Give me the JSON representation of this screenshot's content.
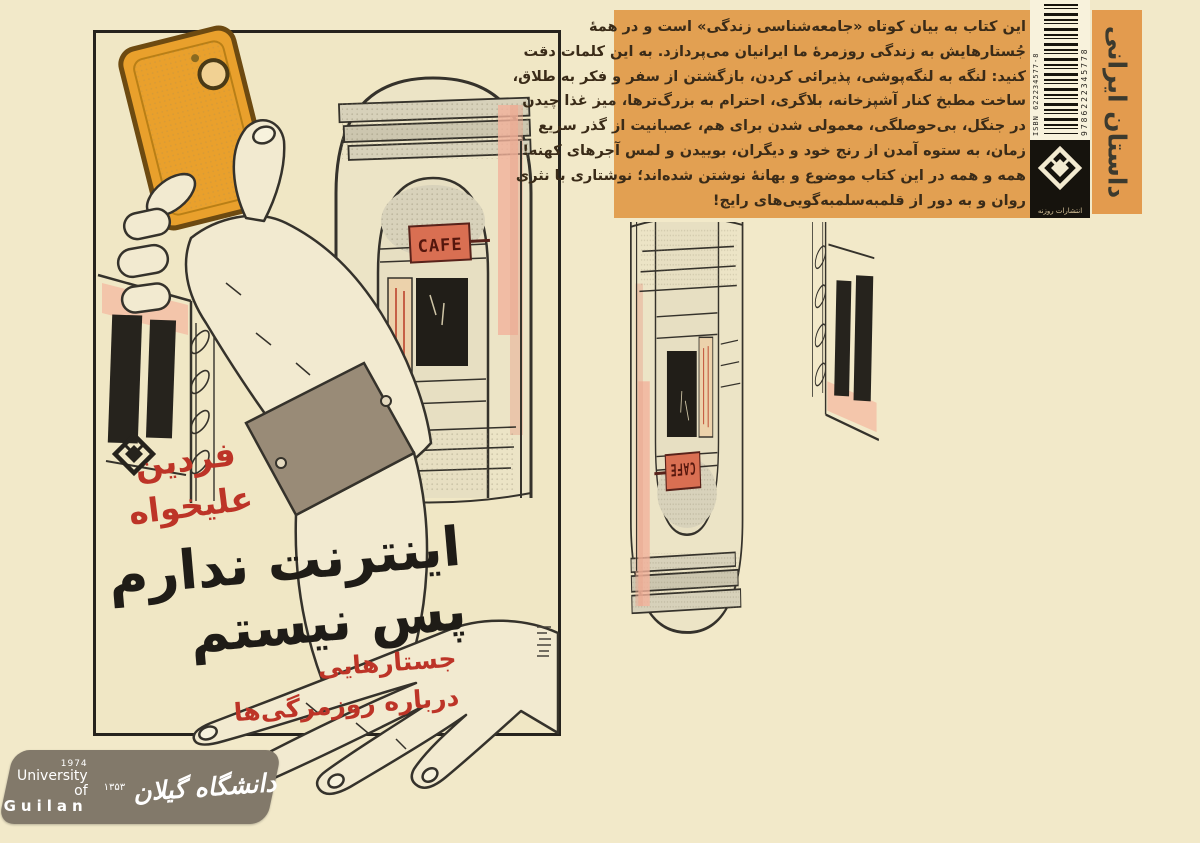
{
  "front_cover": {
    "author_line1": "فردین",
    "author_line2": "علیخواه",
    "title_line1": "اینترنت ندارم",
    "title_line2": "پس نیستم",
    "subtitle_line1": "جستارهایی",
    "subtitle_line2": "درباره روزمرگی‌ها",
    "cafe_sign": "CAFE"
  },
  "back_cover": {
    "blurb_lines": [
      "این کتاب به بیان کوتاه «جامعه‌شناسی زندگی» است و در همهٔ",
      "جُستارهایش به زندگی روزمرهٔ ما ایرانیان می‌پردازد. به این کلمات دقت",
      "کنید: لنگه به لنگه‌پوشی، پذیرائی کردن، بازگشتن از سفر و فکر به طلاق،",
      "ساخت مطبخ کنار آشپزخانه، بلاگری، احترام به بزرگ‌ترها، میز غذا چیدن",
      "در جنگل، بی‌حوصلگی، معمولی شدن برای هم، عصبانیت از گذر سریع",
      "زمان، به ستوه آمدن از رنج خود و دیگران، بوییدن و لمس آجرهای کهنه!",
      "همه و همه در این کتاب موضوع و بهانهٔ نوشتن شده‌اند؛ نوشتاری با نثری",
      "روان و به دور از قلمبه‌سلمبه‌گویی‌های رایج!"
    ],
    "category_label": "داستان ایرانی",
    "publisher_name": "انتشارات روزنه",
    "isbn_label": "ISBN 622234577-8",
    "barcode_number": "9786222345778"
  },
  "footer_logo": {
    "year_en": "1974",
    "org_en_line1": "University of",
    "org_en_line2": "Guilan",
    "year_fa": "۱۳۵۳",
    "org_fa": "دانشگاه گیلان"
  },
  "icons": {
    "publisher_logo": "rowzaneh-diamond-logo",
    "emblem": "guilan-university-emblem",
    "camera": "phone-camera-lens"
  },
  "colors": {
    "background": "#f2e9c9",
    "orange_panel": "#e2a052",
    "phone_orange": "#e9a02c",
    "cafe_red": "#d96f52",
    "accent_red": "#bd3427",
    "ink": "#26231d",
    "banner_taupe": "#82796a",
    "barcode_bg": "#f8f2dc"
  }
}
